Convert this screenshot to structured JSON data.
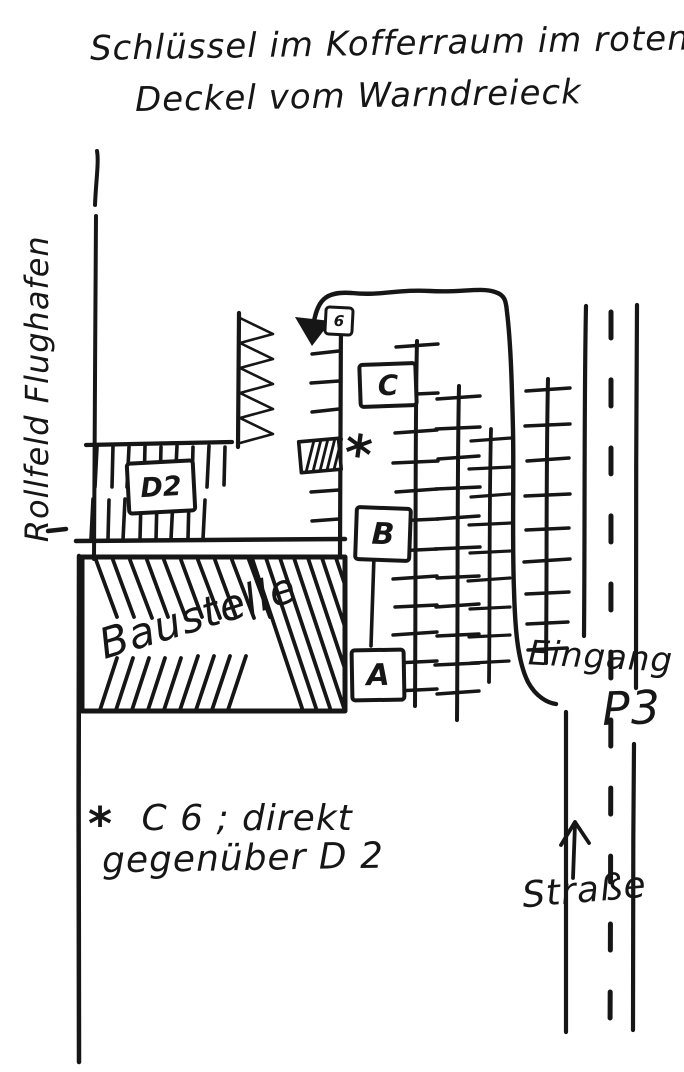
{
  "title": {
    "line1": "Schlüssel im Kofferraum im roten",
    "line2": "Deckel vom Warndreieck"
  },
  "labels": {
    "airfield": "Rollfeld Flughafen",
    "construction": "Baustelle",
    "entrance": "Eingang",
    "entrance_lot": "P3",
    "street": "Straße"
  },
  "parking_boxes": {
    "six": "6",
    "c": "C",
    "b": "B",
    "a": "A",
    "d2": "D2"
  },
  "note": {
    "marker": "*",
    "line1": "C 6 ; direkt",
    "line2": "gegenüber  D 2"
  },
  "spot_marker": "*",
  "colors": {
    "ink": "#161616",
    "paper": "#ffffff"
  }
}
